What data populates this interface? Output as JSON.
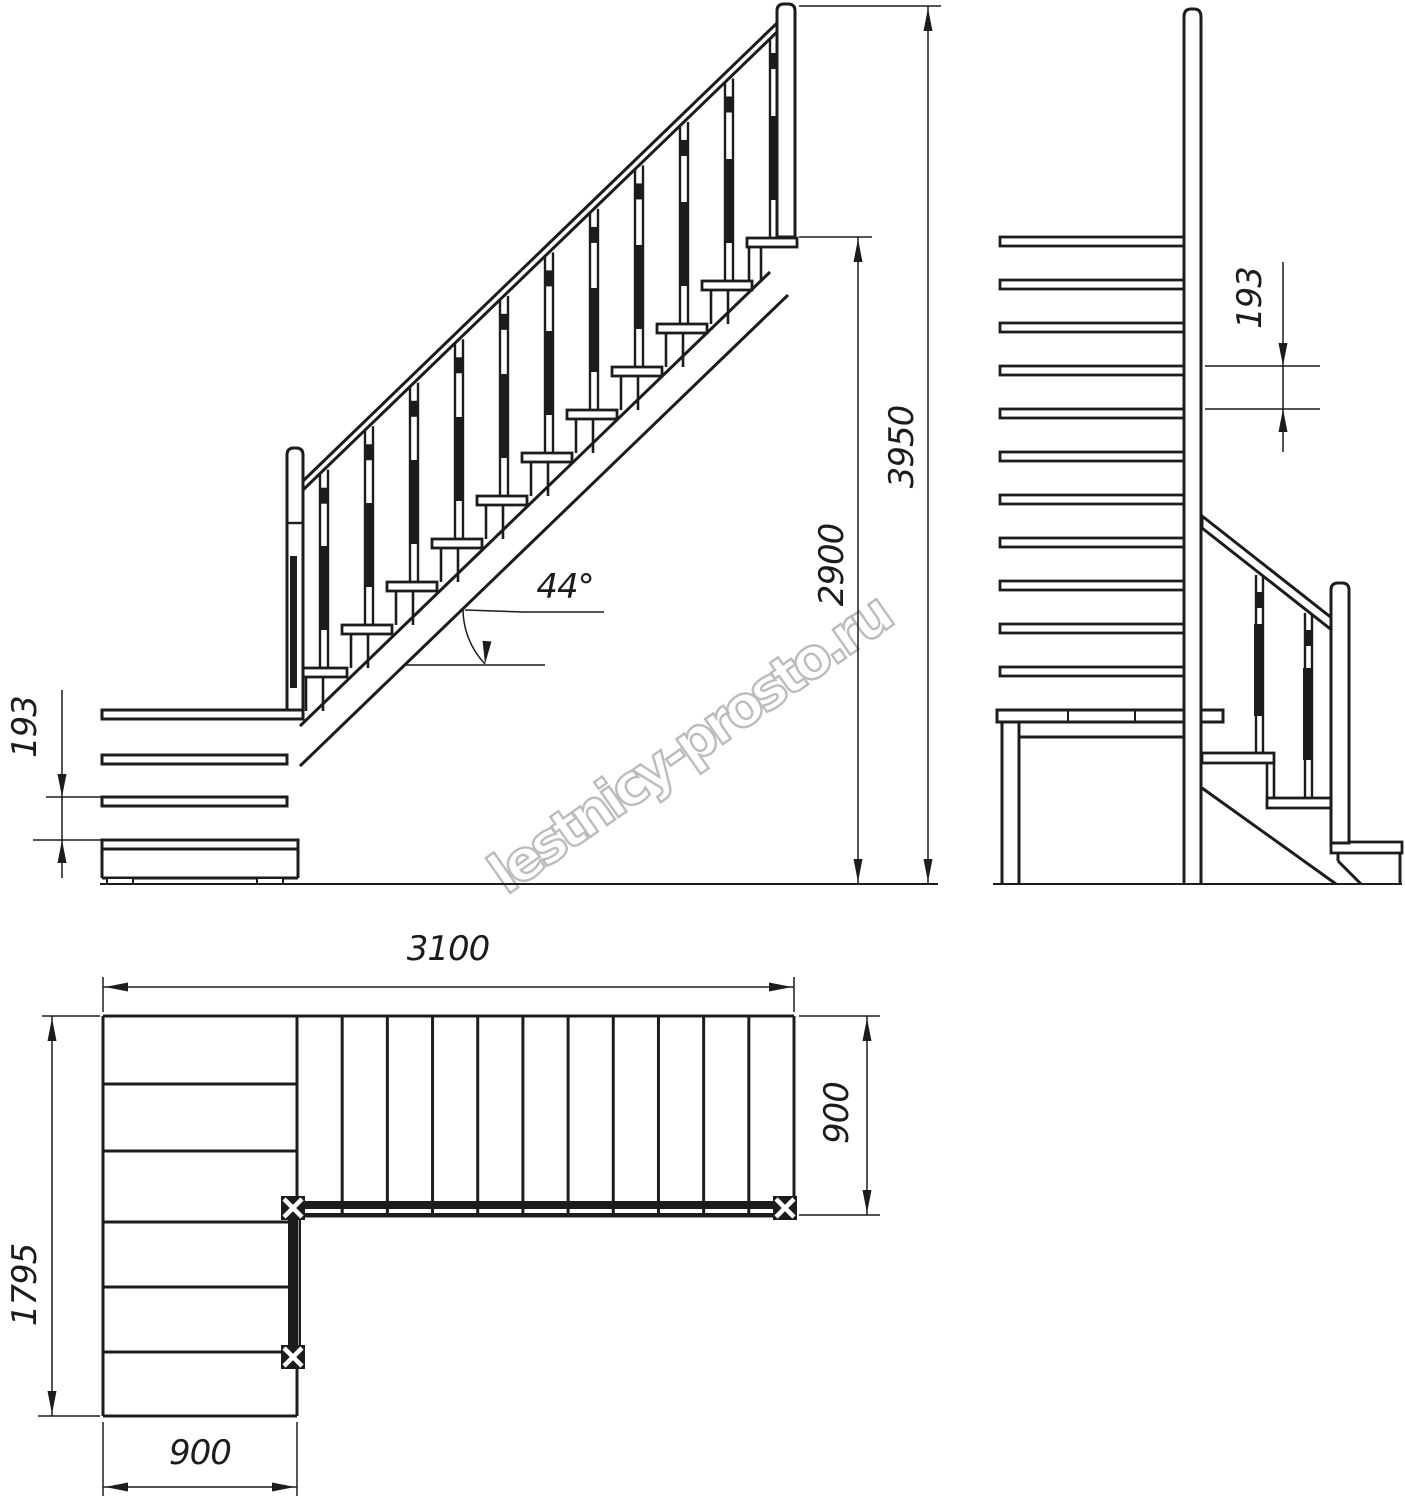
{
  "watermark": {
    "text": "lestnicy-prosto.ru"
  },
  "side_view": {
    "riser_label": "193",
    "angle_label": "44°",
    "floor_height_label": "2900",
    "total_height_label": "3950"
  },
  "front_view": {
    "riser_label": "193"
  },
  "plan_view": {
    "length_label": "3100",
    "depth_label": "1795",
    "width_bottom_label": "900",
    "width_right_label": "900"
  },
  "structure": {
    "upper_flight_treads": 11,
    "lower_flight_steps": 3,
    "landing_plank_joints": 2,
    "plan_upper_tread_columns": 11,
    "riser_mm": 193,
    "tread_run_mm": 200,
    "angle_deg": 44
  }
}
